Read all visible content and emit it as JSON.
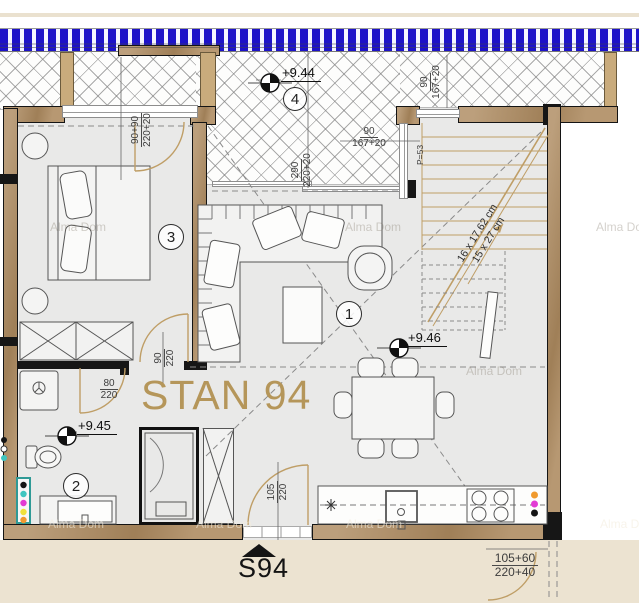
{
  "plan": {
    "title": "STAN 94",
    "compass_label": "S94",
    "watermark": "Alma Dom",
    "rooms": {
      "living": "1",
      "bath": "2",
      "bedroom": "3",
      "terrace": "4"
    },
    "elevations": {
      "terrace": "+9.44",
      "bath": "+9.45",
      "living": "+9.46"
    },
    "area_label": "P=53",
    "stairs": {
      "line1": "16 x 17.62 cm",
      "line2": "15 x 27 cm"
    },
    "dims": {
      "terrace_left": {
        "num": "90+90",
        "den": "220+20"
      },
      "terrace_mid": {
        "num": "290",
        "den": "220+20"
      },
      "terrace_top": {
        "num": "90",
        "den": "167+20"
      },
      "terrace_right": {
        "num": "90",
        "den": "167+20"
      },
      "bedroom_door": {
        "num": "90",
        "den": "220"
      },
      "bath_door": {
        "num": "80",
        "den": "220"
      },
      "entry_door": {
        "num": "105",
        "den": "220"
      },
      "exterior_door": {
        "num": "105+60",
        "den": "220+40"
      }
    },
    "colors": {
      "wall": "#ad8a5f",
      "railing": "#1d12c8",
      "title": "#b5965a",
      "outside": "#ece3d1"
    }
  }
}
